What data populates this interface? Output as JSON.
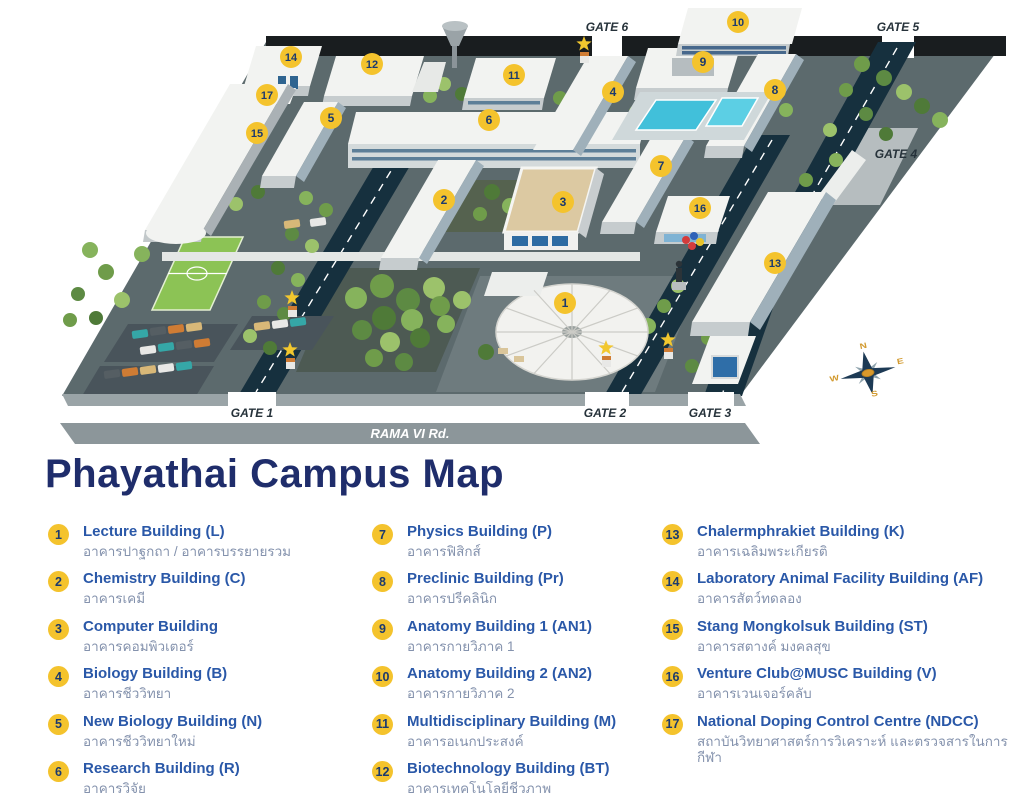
{
  "page": {
    "title": "Phayathai Campus Map"
  },
  "map": {
    "road_label": "RAMA VI Rd.",
    "gates": [
      {
        "label": "GATE 1",
        "x": 252,
        "y": 417
      },
      {
        "label": "GATE 2",
        "x": 605,
        "y": 417
      },
      {
        "label": "GATE 3",
        "x": 710,
        "y": 417
      },
      {
        "label": "GATE 4",
        "x": 896,
        "y": 158
      },
      {
        "label": "GATE 5",
        "x": 898,
        "y": 31
      },
      {
        "label": "GATE 6",
        "x": 607,
        "y": 31
      }
    ],
    "markers": [
      {
        "num": "1",
        "x": 565,
        "y": 303
      },
      {
        "num": "2",
        "x": 444,
        "y": 200
      },
      {
        "num": "3",
        "x": 563,
        "y": 202
      },
      {
        "num": "4",
        "x": 613,
        "y": 92
      },
      {
        "num": "5",
        "x": 331,
        "y": 118
      },
      {
        "num": "6",
        "x": 489,
        "y": 120
      },
      {
        "num": "7",
        "x": 661,
        "y": 166
      },
      {
        "num": "8",
        "x": 775,
        "y": 90
      },
      {
        "num": "9",
        "x": 703,
        "y": 62
      },
      {
        "num": "10",
        "x": 738,
        "y": 22
      },
      {
        "num": "11",
        "x": 514,
        "y": 75
      },
      {
        "num": "12",
        "x": 372,
        "y": 64
      },
      {
        "num": "13",
        "x": 775,
        "y": 263
      },
      {
        "num": "14",
        "x": 291,
        "y": 57
      },
      {
        "num": "15",
        "x": 257,
        "y": 133
      },
      {
        "num": "16",
        "x": 700,
        "y": 208
      },
      {
        "num": "17",
        "x": 267,
        "y": 95
      }
    ],
    "compass": {
      "points": [
        "N",
        "E",
        "S",
        "W"
      ]
    }
  },
  "legend": {
    "columns": [
      [
        {
          "num": "1",
          "en": "Lecture Building (L)",
          "th": "อาคารปาฐกถา / อาคารบรรยายรวม"
        },
        {
          "num": "2",
          "en": "Chemistry Building (C)",
          "th": "อาคารเคมี"
        },
        {
          "num": "3",
          "en": "Computer Building",
          "th": "อาคารคอมพิวเตอร์"
        },
        {
          "num": "4",
          "en": "Biology Building (B)",
          "th": "อาคารชีววิทยา"
        },
        {
          "num": "5",
          "en": "New Biology Building (N)",
          "th": "อาคารชีววิทยาใหม่"
        },
        {
          "num": "6",
          "en": "Research Building (R)",
          "th": "อาคารวิจัย"
        }
      ],
      [
        {
          "num": "7",
          "en": "Physics Building (P)",
          "th": "อาคารฟิสิกส์"
        },
        {
          "num": "8",
          "en": "Preclinic Building (Pr)",
          "th": "อาคารปรีคลินิก"
        },
        {
          "num": "9",
          "en": "Anatomy Building 1 (AN1)",
          "th": "อาคารกายวิภาค 1"
        },
        {
          "num": "10",
          "en": "Anatomy Building 2 (AN2)",
          "th": "อาคารกายวิภาค 2"
        },
        {
          "num": "11",
          "en": "Multidisciplinary  Building (M)",
          "th": "อาคารอเนกประสงค์"
        },
        {
          "num": "12",
          "en": "Biotechnology Building (BT)",
          "th": "อาคารเทคโนโลยีชีวภาพ"
        }
      ],
      [
        {
          "num": "13",
          "en": "Chalermphrakiet Building (K)",
          "th": "อาคารเฉลิมพระเกียรติ"
        },
        {
          "num": "14",
          "en": "Laboratory Animal Facility Building (AF)",
          "th": "อาคารสัตว์ทดลอง"
        },
        {
          "num": "15",
          "en": "Stang Mongkolsuk Building (ST)",
          "th": "อาคารสตางค์ มงคลสุข"
        },
        {
          "num": "16",
          "en": "Venture Club@MUSC Building (V)",
          "th": "อาคารเวนเจอร์คลับ"
        },
        {
          "num": "17",
          "en": "National Doping Control Centre (NDCC)",
          "th": "สถาบันวิทยาศาสตร์การวิเคราะห์ และตรวจสารในการกีฬา"
        }
      ]
    ]
  },
  "colors": {
    "title_navy": "#1f2d6b",
    "legend_blue": "#2a58a8",
    "thai_gray": "#8492ad",
    "badge_yellow": "#f4c32d",
    "badge_text": "#1c3a6e",
    "road_navy": "#16303e",
    "ground_gray": "#5c6a6d",
    "building_white": "#f2f3f1",
    "field_green": "#8cc355",
    "pool_cyan": "#41c0da",
    "star_yellow": "#f2c72e",
    "gate_text": "#26323a"
  }
}
